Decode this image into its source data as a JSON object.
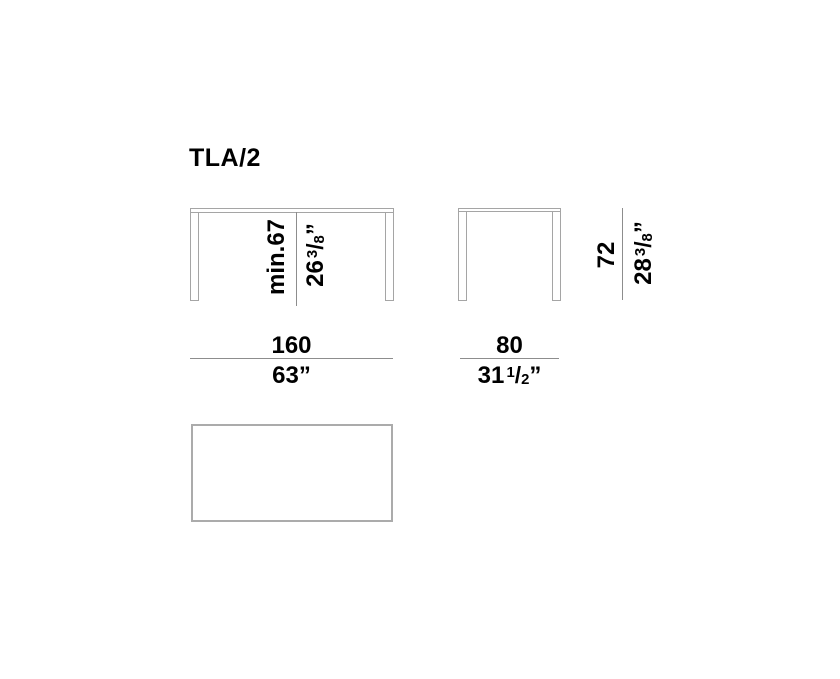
{
  "title": "TLA/2",
  "drawing": {
    "front_view": {
      "height_dim": {
        "metric": "min.67",
        "imperial": {
          "whole": "26",
          "num": "3",
          "slash": "/",
          "den": "8",
          "mark": "”"
        }
      },
      "width_dim": {
        "metric": "160",
        "imperial": {
          "whole": "63",
          "mark": "”"
        }
      }
    },
    "side_view": {
      "height_dim": {
        "metric": "72",
        "imperial": {
          "whole": "28",
          "num": "3",
          "slash": "/",
          "den": "8",
          "mark": "”"
        }
      },
      "width_dim": {
        "metric": "80",
        "imperial": {
          "whole": "31",
          "num": "1",
          "slash": "/",
          "den": "2",
          "mark": "”"
        }
      }
    },
    "colors": {
      "outline": "#a5a5a5",
      "dimension_line": "#8d8d8d",
      "text": "#000000",
      "background": "#ffffff"
    }
  }
}
